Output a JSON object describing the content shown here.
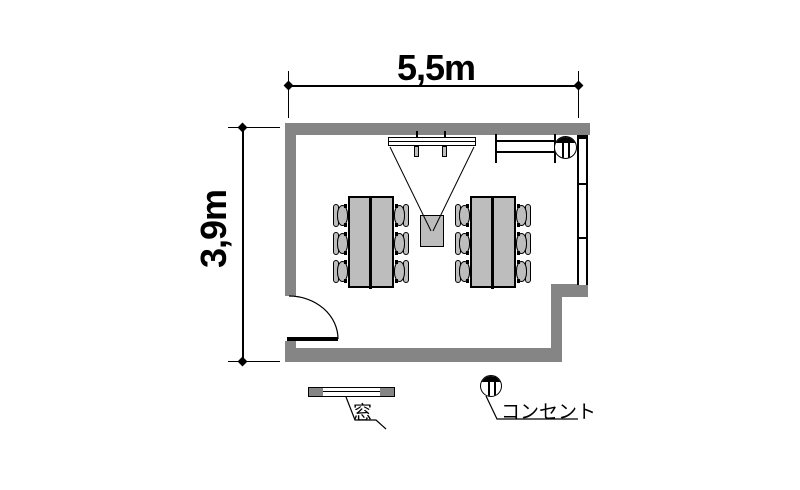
{
  "dimensions": {
    "width_label": "5,5m",
    "height_label": "3,9m"
  },
  "legend": {
    "window_label": "窓",
    "outlet_label": "コンセント"
  },
  "symbols": {
    "outlet": "hatched-circle-half-filled",
    "window": "double-line-bar",
    "door": "quarter-circle-swing",
    "projector": "cone-projection-to-screen"
  },
  "colors": {
    "wall": "#858585",
    "furniture": "#bdbdbd",
    "line": "#000000",
    "bg": "#ffffff"
  }
}
